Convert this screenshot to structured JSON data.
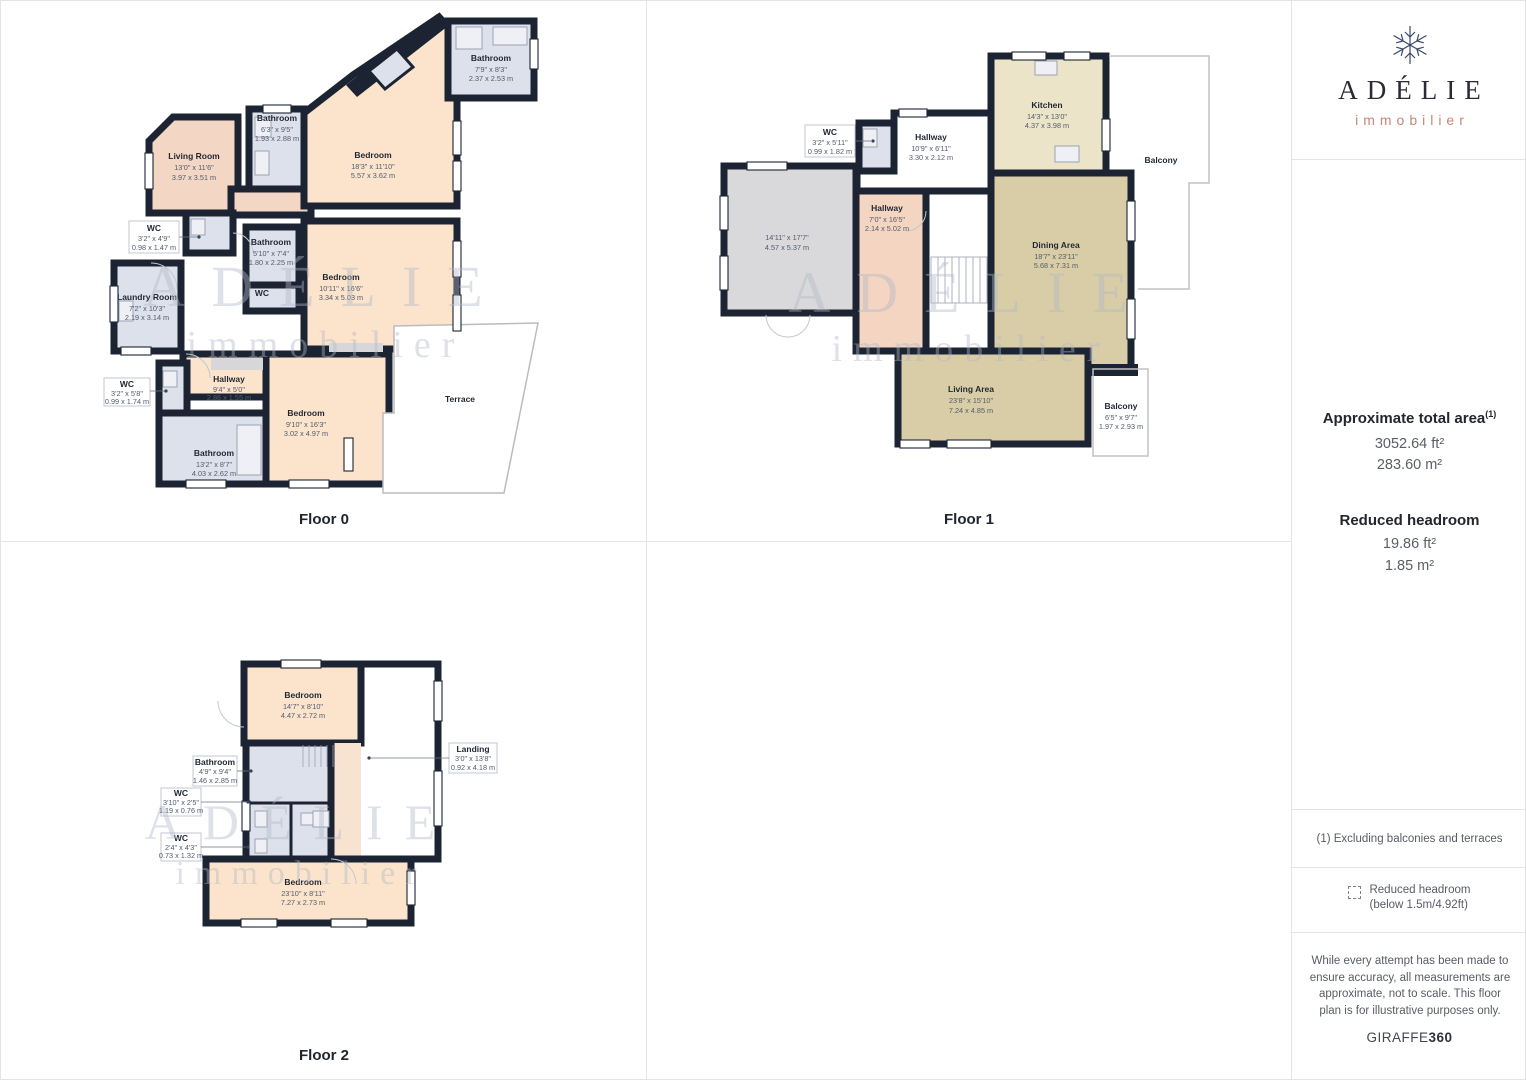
{
  "sidebar": {
    "brand": {
      "name": "ADÉLIE",
      "tagline": "immobilier"
    },
    "total_area": {
      "title": "Approximate total area",
      "footnote_ref": "(1)",
      "value_ft": "3052.64 ft²",
      "value_m": "283.60 m²"
    },
    "reduced_headroom": {
      "title": "Reduced headroom",
      "value_ft": "19.86 ft²",
      "value_m": "1.85 m²"
    },
    "footnote": "(1) Excluding balconies and terraces",
    "legend": {
      "title": "Reduced headroom",
      "subtitle": "(below 1.5m/4.92ft)"
    },
    "disclaimer": "While every attempt has been made to ensure accuracy, all measurements are approximate, not to scale. This floor plan is for illustrative purposes only.",
    "brand_mark": {
      "name": "GIRAFFE",
      "suffix": "360"
    }
  },
  "watermark": {
    "line1": "ADÉLIE",
    "line2": "immobilier"
  },
  "colors": {
    "wall": "#1c2433",
    "bedroom": "#fbe3cc",
    "living": "#f3d6c3",
    "bathroom": "#dde1ec",
    "kitchen": "#ece4c9",
    "dining": "#d9cda7",
    "hallway": "#f4d5c2",
    "gray_room": "#d9d9db",
    "accent": "#c9857a"
  },
  "floors": [
    {
      "label": "Floor 0",
      "rooms": [
        {
          "name": "Living Room",
          "ft": "13'0\" x 11'6\"",
          "m": "3.97 x 3.51 m"
        },
        {
          "name": "Bathroom",
          "ft": "6'3\" x 9'5\"",
          "m": "1.93 x 2.88 m"
        },
        {
          "name": "Bedroom",
          "ft": "18'3\" x 11'10\"",
          "m": "5.57 x 3.62 m"
        },
        {
          "name": "Bathroom",
          "ft": "7'9\" x 8'3\"",
          "m": "2.37 x 2.53 m"
        },
        {
          "name": "WC",
          "ft": "3'2\" x 4'9\"",
          "m": "0.98 x 1.47 m"
        },
        {
          "name": "Bathroom",
          "ft": "5'10\" x 7'4\"",
          "m": "1.80 x 2.25 m"
        },
        {
          "name": "WC"
        },
        {
          "name": "Laundry Room",
          "ft": "7'2\" x 10'3\"",
          "m": "2.19 x 3.14 m"
        },
        {
          "name": "Bedroom",
          "ft": "10'11\" x 16'6\"",
          "m": "3.34 x 5.03 m"
        },
        {
          "name": "WC",
          "ft": "3'2\" x 5'8\"",
          "m": "0.99 x 1.74 m"
        },
        {
          "name": "Hallway",
          "ft": "9'4\" x 5'0\"",
          "m": "2.86 x 1.55 m"
        },
        {
          "name": "Bedroom",
          "ft": "9'10\" x 16'3\"",
          "m": "3.02 x 4.97 m"
        },
        {
          "name": "Bathroom",
          "ft": "13'2\" x 8'7\"",
          "m": "4.03 x 2.62 m"
        },
        {
          "name": "Terrace"
        }
      ]
    },
    {
      "label": "Floor 1",
      "rooms": [
        {
          "name": "WC",
          "ft": "3'2\" x 5'11\"",
          "m": "0.99 x 1.82 m"
        },
        {
          "name": "Hallway",
          "ft": "10'9\" x 6'11\"",
          "m": "3.30 x 2.12 m"
        },
        {
          "name": "Kitchen",
          "ft": "14'3\" x 13'0\"",
          "m": "4.37 x 3.98 m"
        },
        {
          "name": "Balcony"
        },
        {
          "name": "",
          "ft": "14'11\" x 17'7\"",
          "m": "4.57 x 5.37 m"
        },
        {
          "name": "Hallway",
          "ft": "7'0\" x 16'5\"",
          "m": "2.14 x 5.02 m"
        },
        {
          "name": "Dining Area",
          "ft": "18'7\" x 23'11\"",
          "m": "5.68 x 7.31 m"
        },
        {
          "name": "Living Area",
          "ft": "23'8\" x 15'10\"",
          "m": "7.24 x 4.85 m"
        },
        {
          "name": "Balcony",
          "ft": "6'5\" x 9'7\"",
          "m": "1.97 x 2.93 m"
        }
      ]
    },
    {
      "label": "Floor 2",
      "rooms": [
        {
          "name": "Bedroom",
          "ft": "14'7\" x 8'10\"",
          "m": "4.47 x 2.72 m"
        },
        {
          "name": "Landing",
          "ft": "3'0\" x 13'8\"",
          "m": "0.92 x 4.18 m"
        },
        {
          "name": "Bathroom",
          "ft": "4'9\" x 9'4\"",
          "m": "1.46 x 2.85 m"
        },
        {
          "name": "WC",
          "ft": "3'10\" x 2'5\"",
          "m": "1.19 x 0.76 m"
        },
        {
          "name": "WC",
          "ft": "2'4\" x 4'3\"",
          "m": "0.73 x 1.32 m"
        },
        {
          "name": "Bedroom",
          "ft": "23'10\" x 8'11\"",
          "m": "7.27 x 2.73 m"
        }
      ]
    }
  ]
}
